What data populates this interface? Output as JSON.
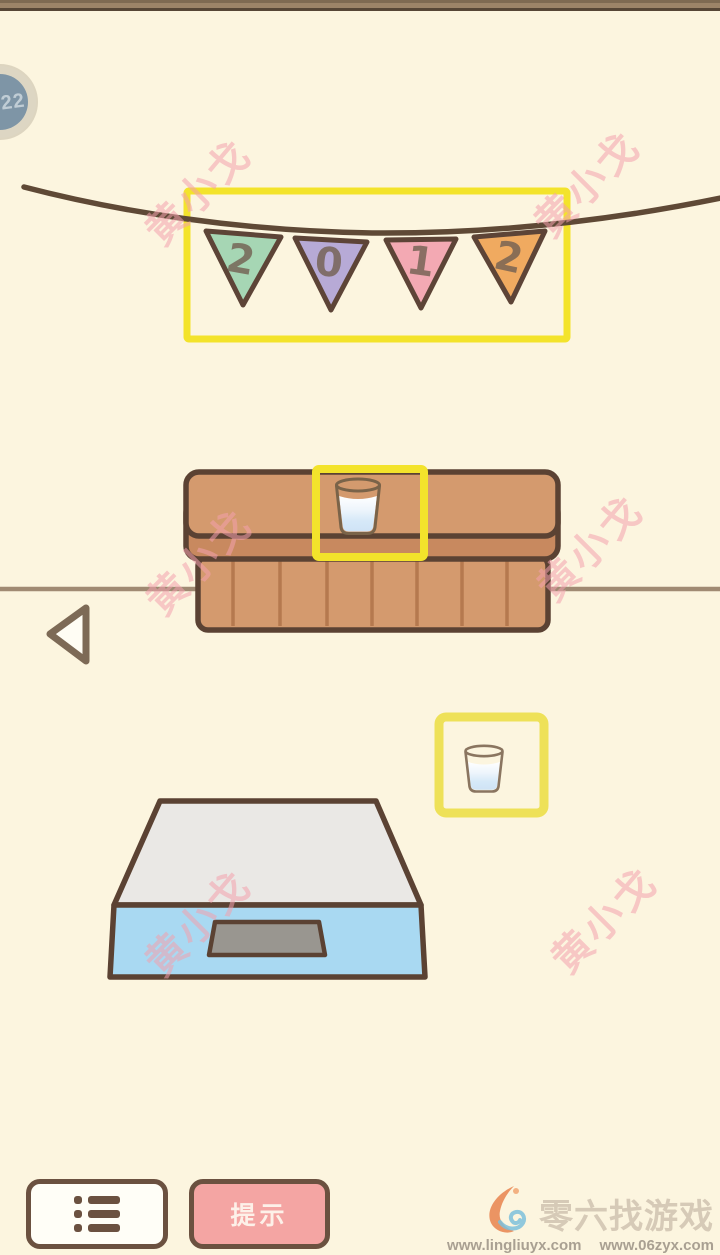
{
  "app": {
    "level_badge": "22",
    "watermark_text": "黄小戈"
  },
  "banner": {
    "year": "2012",
    "flags": [
      {
        "digit": "2",
        "color": "#a6d6b4"
      },
      {
        "digit": "0",
        "color": "#b7aad6"
      },
      {
        "digit": "1",
        "color": "#f3a9b3"
      },
      {
        "digit": "2",
        "color": "#f0aa60"
      }
    ]
  },
  "buttons": {
    "hint_label": "提示"
  },
  "icons": {
    "menu": "list-icon",
    "back": "back-arrow-icon",
    "logo": "flame-logo-icon"
  },
  "footer": {
    "brand": "零六找游戏",
    "url_left": "www.lingliuyx.com",
    "url_right": "www.06zyx.com"
  },
  "colors": {
    "background": "#fcf5df",
    "highlight_yellow": "#f3e32b",
    "outline_brown": "#5b4233",
    "cabinet_brown": "#d49a6e",
    "scale_blue": "#a9d9f2",
    "hint_pink": "#f4a5a3",
    "watermark_pink": "#f2a0ad"
  }
}
